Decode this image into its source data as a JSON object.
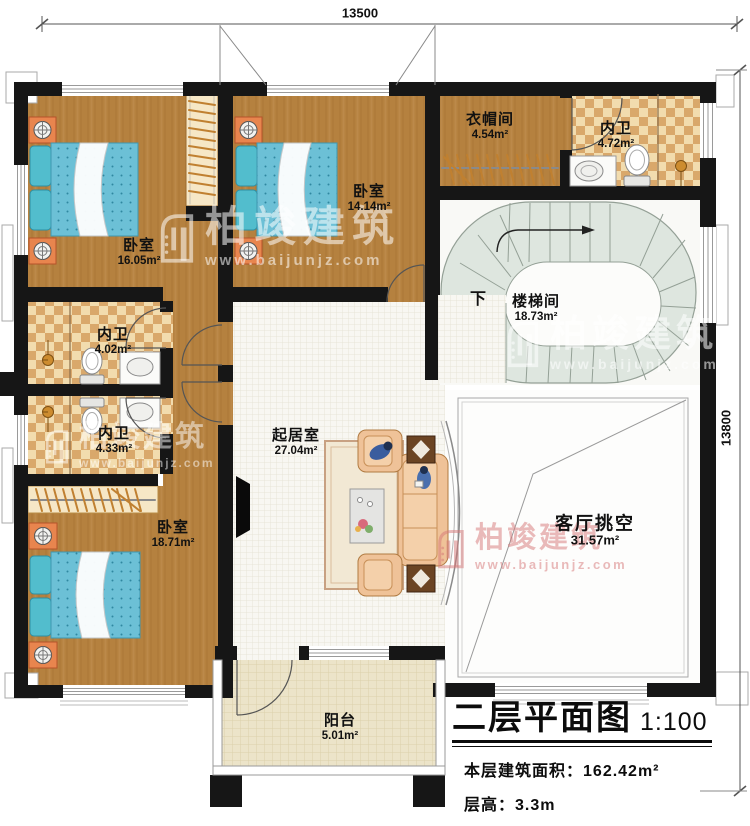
{
  "dimensions": {
    "top": "13500",
    "right": "13800"
  },
  "rooms": [
    {
      "id": "bedroom-1",
      "name": "卧室",
      "area": "16.05m²"
    },
    {
      "id": "bedroom-2",
      "name": "卧室",
      "area": "14.14m²"
    },
    {
      "id": "cloakroom",
      "name": "衣帽间",
      "area": "4.54m²"
    },
    {
      "id": "bath-north",
      "name": "内卫",
      "area": "4.72m²"
    },
    {
      "id": "stairwell",
      "name": "楼梯间",
      "area": "18.73m²"
    },
    {
      "id": "bath-west",
      "name": "内卫",
      "area": "4.02m²"
    },
    {
      "id": "bath-southwest",
      "name": "内卫",
      "area": "4.33m²"
    },
    {
      "id": "bedroom-3",
      "name": "卧室",
      "area": "18.71m²"
    },
    {
      "id": "living-room",
      "name": "起居室",
      "area": "27.04m²"
    },
    {
      "id": "living-void",
      "name": "客厅挑空",
      "area": "31.57m²"
    },
    {
      "id": "balcony",
      "name": "阳台",
      "area": "5.01m²"
    }
  ],
  "labels": {
    "stair_down": "下"
  },
  "title_block": {
    "title": "二层平面图",
    "scale": "1:100",
    "floor_area_label": "本层建筑面积：",
    "floor_area_value": "162.42m²",
    "floor_height_label": "层高：",
    "floor_height_value": "3.3m"
  },
  "watermark": {
    "brand": "柏竣建筑",
    "url": "www.baijunjz.com"
  },
  "fixtures": [
    "bed",
    "pillow",
    "nightstand-lamp",
    "wardrobe-rail",
    "toilet",
    "sink-vanity",
    "shower-mixer",
    "tv",
    "sofa",
    "armchair",
    "side-table",
    "coffee-table",
    "rug",
    "spiral-stair",
    "person-figure",
    "door-swing",
    "window",
    "dimension-line"
  ],
  "colors": {
    "wall": "#161616",
    "wood_floor": "#b5813f",
    "tile_light": "#f2dcae",
    "tile_dark": "#d9a86b",
    "stair_tread": "#dee6df",
    "mattress_blue": "#6cc0d6",
    "nightstand_orange": "#e8854e",
    "sofa_tan": "#efc298",
    "watermark_white": "rgba(255,255,255,0.55)",
    "watermark_red": "rgba(214,118,118,0.5)"
  }
}
